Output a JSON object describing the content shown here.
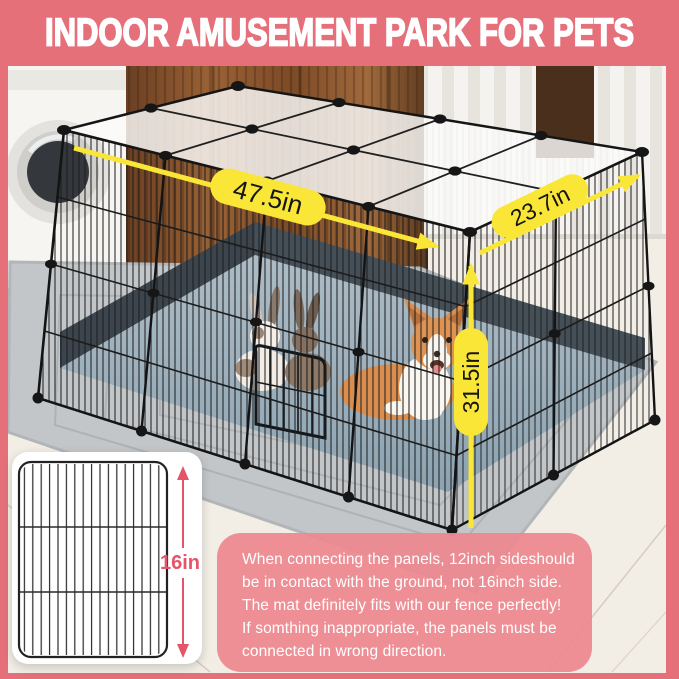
{
  "header": {
    "title": "INDOOR AMUSEMENT PARK FOR PETS",
    "bg_color": "#e5707a",
    "text_color": "#ffffff"
  },
  "photo": {
    "dimension_labels": {
      "width": "47.5in",
      "depth": "23.7in",
      "height": "31.5in"
    },
    "annotation_color": "#f9e636",
    "mat_color": "#8da3b1"
  },
  "panel_card": {
    "height_label": "16in",
    "accent_color": "#e4556a"
  },
  "note_box": {
    "bg_color": "#ec8990",
    "text_color": "#ffffff",
    "lines": [
      "When connecting the panels, 12inch sideshould",
      "be in contact with the ground, not 16inch side.",
      "The mat definitely fits with our fence perfectly!",
      "If somthing inappropriate, the panels must be",
      "connected in wrong direction."
    ]
  }
}
